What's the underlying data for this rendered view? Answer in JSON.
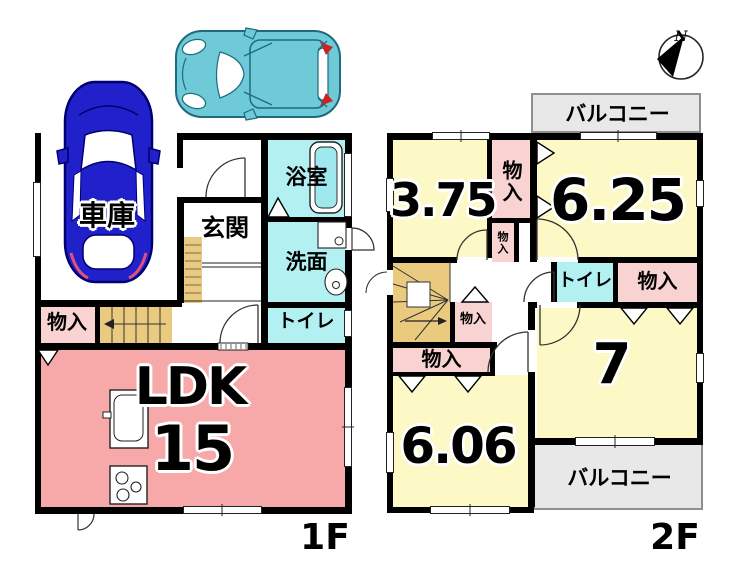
{
  "f1": {
    "label": "1F",
    "garage": "車庫",
    "entrance": "玄関",
    "bath": "浴室",
    "wash": "洗面",
    "toilet": "トイレ",
    "closet": "物入",
    "ldk": "LDK",
    "ldk_size": "15"
  },
  "f2": {
    "label": "2F",
    "balcony_top": "バルコニー",
    "balcony_bottom": "バルコニー",
    "room_375": "3.75",
    "room_625": "6.25",
    "room_7": "7",
    "room_606": "6.06",
    "toilet": "トイレ",
    "closet_tall": "物入",
    "closet_upper_small": "物入",
    "closet_hall_small": "物入",
    "closet_west": "物入",
    "closet_east": "物入"
  },
  "compass": {
    "north": "N"
  },
  "colors": {
    "room_pink": "#f7a9a9",
    "closet_pink": "#f9d2d2",
    "wet_cyan": "#b3f0f2",
    "room_yellow": "#fcf9c6",
    "stairs_tan": "#e9ca7f",
    "balcony_gray": "#e8e8e8",
    "wall": "#000000",
    "car_blue": "#2121cc",
    "car_teal": "#6ecad6",
    "taillight_red": "#cc2222"
  }
}
